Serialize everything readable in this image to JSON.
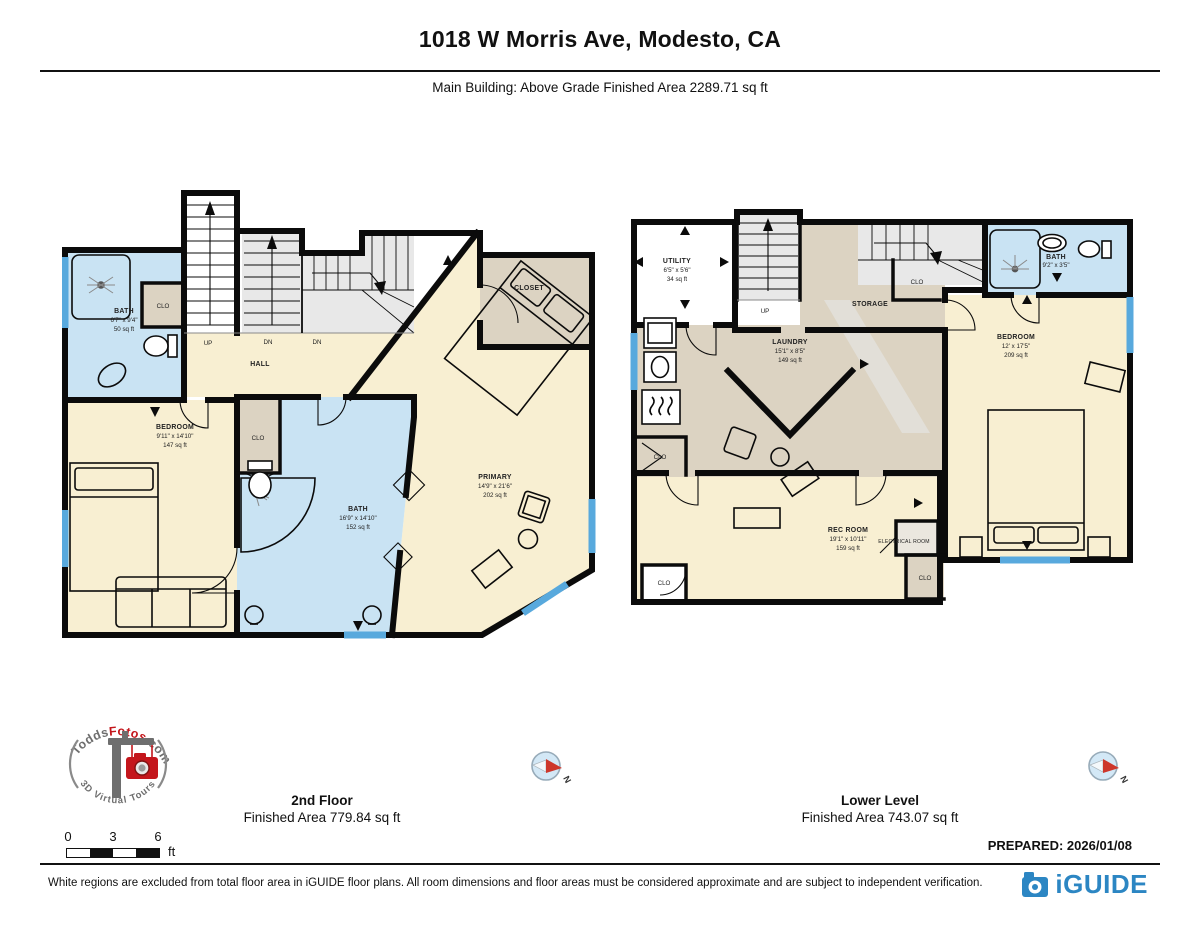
{
  "header": {
    "title": "1018 W Morris Ave, Modesto, CA",
    "subtitle": "Main Building: Above Grade Finished Area 2289.71 sq ft"
  },
  "plans": {
    "second": {
      "floor_name": "2nd Floor",
      "floor_area": "Finished Area 779.84 sq ft",
      "labels": {
        "bath_small": {
          "name": "BATH",
          "dims": "6'7\" x 9'4\"",
          "area": "50 sq ft"
        },
        "clo_upper": "CLO",
        "up": "UP",
        "dn1": "DN",
        "dn2": "DN",
        "hall": "HALL",
        "closet": "CLOSET",
        "bedroom": {
          "name": "BEDROOM",
          "dims": "9'11\" x 14'10\"",
          "area": "147 sq ft"
        },
        "clo_mid": "CLO",
        "bath": {
          "name": "BATH",
          "dims": "16'9\" x 14'10\"",
          "area": "152 sq ft"
        },
        "primary": {
          "name": "PRIMARY",
          "dims": "14'9\" x 21'6\"",
          "area": "202 sq ft"
        }
      }
    },
    "lower": {
      "floor_name": "Lower Level",
      "floor_area": "Finished Area 743.07 sq ft",
      "labels": {
        "utility": {
          "name": "UTILITY",
          "dims": "6'5\" x 5'6\"",
          "area": "34 sq ft"
        },
        "up": "UP",
        "storage": "STORAGE",
        "clo_top": "CLO",
        "laundry": {
          "name": "LAUNDRY",
          "dims": "15'1\" x 8'5\"",
          "area": "149 sq ft"
        },
        "bath": {
          "name": "BATH",
          "dims": "9'2\" x 3'5\""
        },
        "bedroom": {
          "name": "BEDROOM",
          "dims": "12' x 17'5\"",
          "area": "209 sq ft"
        },
        "rec_room": {
          "name": "REC ROOM",
          "dims": "19'1\" x 10'11\"",
          "area": "159 sq ft"
        },
        "electrical": "ELECTRICAL ROOM",
        "clo_left": "CLO",
        "clo_bottom_left": "CLO",
        "clo_bottom_right": "CLO"
      }
    }
  },
  "compass": {
    "n": "N"
  },
  "logo": {
    "part1": "Todds",
    "part2": "Fotos",
    "part3": ".com",
    "tagline": "3D Virtual Tours"
  },
  "scale_bar": {
    "t0": "0",
    "t1": "3",
    "t2": "6",
    "unit": "ft"
  },
  "prepared": "PREPARED: 2026/01/08",
  "footer": {
    "disclaimer": "White regions are excluded from total floor area in iGUIDE floor plans. All room dimensions and floor areas must be considered approximate and are subject to independent verification.",
    "brand": "iGUIDE"
  },
  "colors": {
    "room_cream": "#F8EFD2",
    "room_tan": "#DCD3C2",
    "room_blue": "#C9E3F3",
    "window_blue": "#58A9DD",
    "stair_gray": "#E8E8E8",
    "wall": "#0b0b0b",
    "brand_blue": "#2C86C3",
    "logo_red": "#C4161C",
    "logo_gray": "#6E6E6E"
  }
}
